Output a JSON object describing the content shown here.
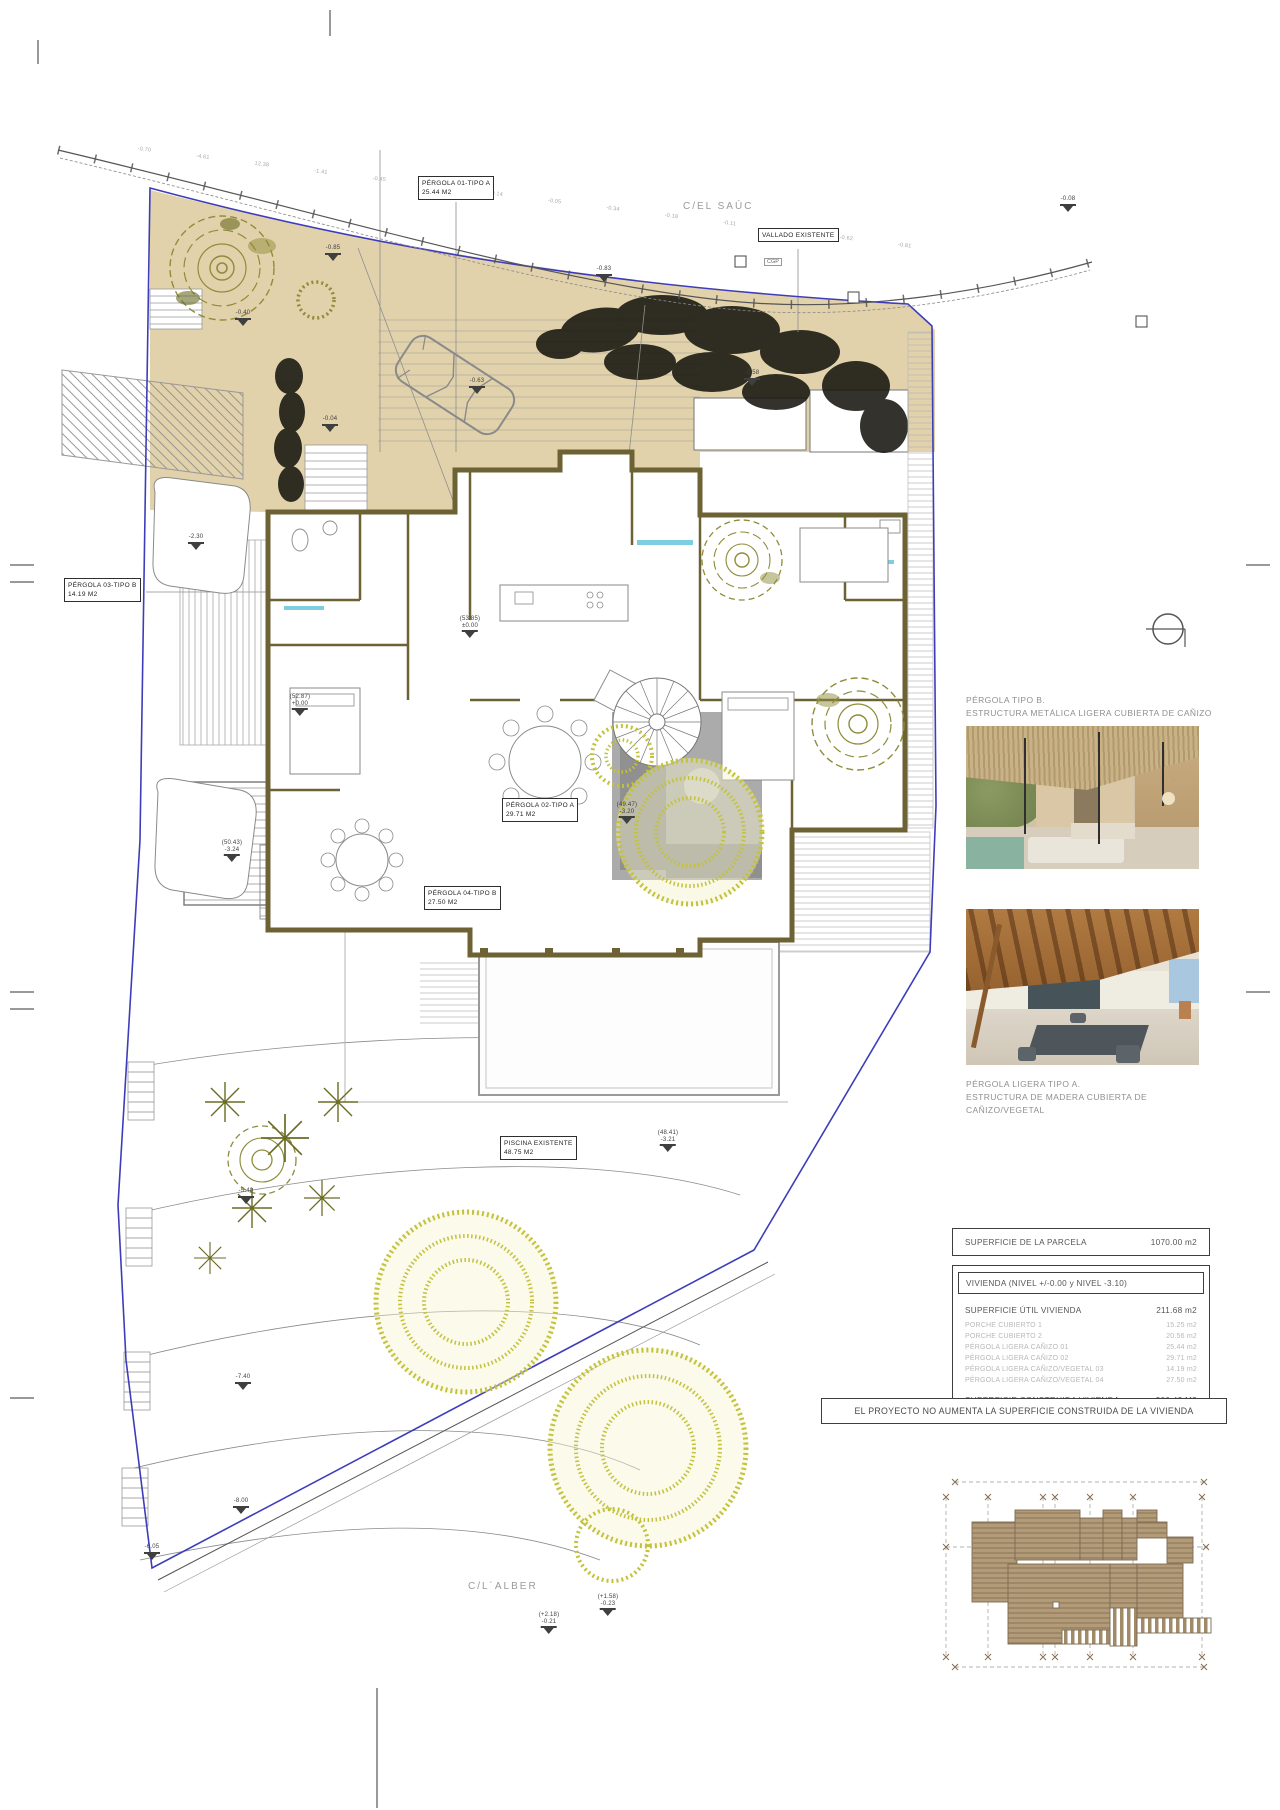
{
  "plan": {
    "street_top": "C/EL SAÚC",
    "street_bottom": "C/L´ALBER",
    "cgp_label": "CGP",
    "top_dims": [
      "-0.70",
      "-4.61",
      "12.38",
      "-1.41",
      "-0.45",
      "-0.24",
      "-0.14",
      "-0.05",
      "-0.34",
      "-0.18",
      "-0.11",
      "-0.38",
      "-0.62",
      "-0.81"
    ],
    "labels": {
      "pergola01": {
        "l1": "PÉRGOLA 01-TIPO A",
        "l2": "25.44 m2"
      },
      "vallado": {
        "l1": "VALLADO EXISTENTE"
      },
      "pergola03": {
        "l1": "PÉRGOLA 03-TIPO B",
        "l2": "14.19 m2"
      },
      "pergola02": {
        "l1": "PÉRGOLA 02-TIPO A",
        "l2": "29.71 m2"
      },
      "pergola04": {
        "l1": "PÉRGOLA 04-TIPO B",
        "l2": "27.50 m2"
      },
      "piscina": {
        "l1": "PISCINA EXISTENTE",
        "l2": "48.75 m2"
      }
    },
    "markers": [
      {
        "t1": "-0.85"
      },
      {
        "t1": "-0.40"
      },
      {
        "t1": "-0.83"
      },
      {
        "t1": "-0.04"
      },
      {
        "t1": "-0.63"
      },
      {
        "t1": "-0.58"
      },
      {
        "t1": "(53.85)",
        "t2": "±0.00"
      },
      {
        "t1": "-2.30"
      },
      {
        "t1": "(52.87)",
        "t2": "+0.00"
      },
      {
        "t1": "(50.43)",
        "t2": "-3.24"
      },
      {
        "t1": "(49.47)",
        "t2": "-3.20"
      },
      {
        "t1": "(48.41)",
        "t2": "-3.21"
      },
      {
        "t1": "-5.40"
      },
      {
        "t1": "-7.40"
      },
      {
        "t1": "-8.00"
      },
      {
        "t1": "-6.05"
      },
      {
        "t1": "(+2.18)",
        "t2": "-0.21"
      },
      {
        "t1": "(+1.58)",
        "t2": "-0.23"
      },
      {
        "t1": "-0.08"
      }
    ]
  },
  "aside": {
    "pergola_b_title": "PÉRGOLA TIPO B.",
    "pergola_b_sub": "ESTRUCTURA METÁLICA LIGERA CUBIERTA DE CAÑIZO",
    "pergola_a_title": "PÉRGOLA LIGERA TIPO A.",
    "pergola_a_sub": "ESTRUCTURA DE MADERA CUBIERTA DE CAÑIZO/VEGETAL"
  },
  "table": {
    "parcela_label": "SUPERFICIE DE LA PARCELA",
    "parcela_value": "1070.00 m2",
    "vivienda_header": "VIVIENDA (NIVEL +/-0.00 y NIVEL -3.10)",
    "util_label": "SUPERFICIE ÚTIL VIVIENDA",
    "util_value": "211.68 m2",
    "rows": [
      {
        "label": "PORCHE CUBIERTO 1",
        "value": "15.25 m2"
      },
      {
        "label": "PORCHE CUBIERTO 2",
        "value": "20.56 m2"
      },
      {
        "label": "PÉRGOLA LIGERA CAÑIZO 01",
        "value": "25.44 m2"
      },
      {
        "label": "PÉRGOLA LIGERA CAÑIZO 02",
        "value": "29.71 m2"
      },
      {
        "label": "PÉRGOLA LIGERA CAÑIZO/VEGETAL 03",
        "value": "14.19 m2"
      },
      {
        "label": "PÉRGOLA LIGERA CAÑIZO/VEGETAL 04",
        "value": "27.50 m2"
      }
    ],
    "construida_label": "SUPERFICIE CONSTRUIDA VIVIENDA",
    "construida_value": "300.42 M2"
  },
  "banner": "EL PROYECTO NO AUMENTA LA SUPERFICIE CONSTRUIDA DE LA VIVIENDA",
  "colors": {
    "boundary_blue": "#3d3dbb",
    "courtyard_tan": "#e2d2ab",
    "wall_olive": "#6d6234",
    "tree_olive": "#8f8c3a",
    "tree_yellow": "#c2c23c",
    "roof_brown": "#b39a78",
    "bath_cyan": "#7ccfe0"
  }
}
